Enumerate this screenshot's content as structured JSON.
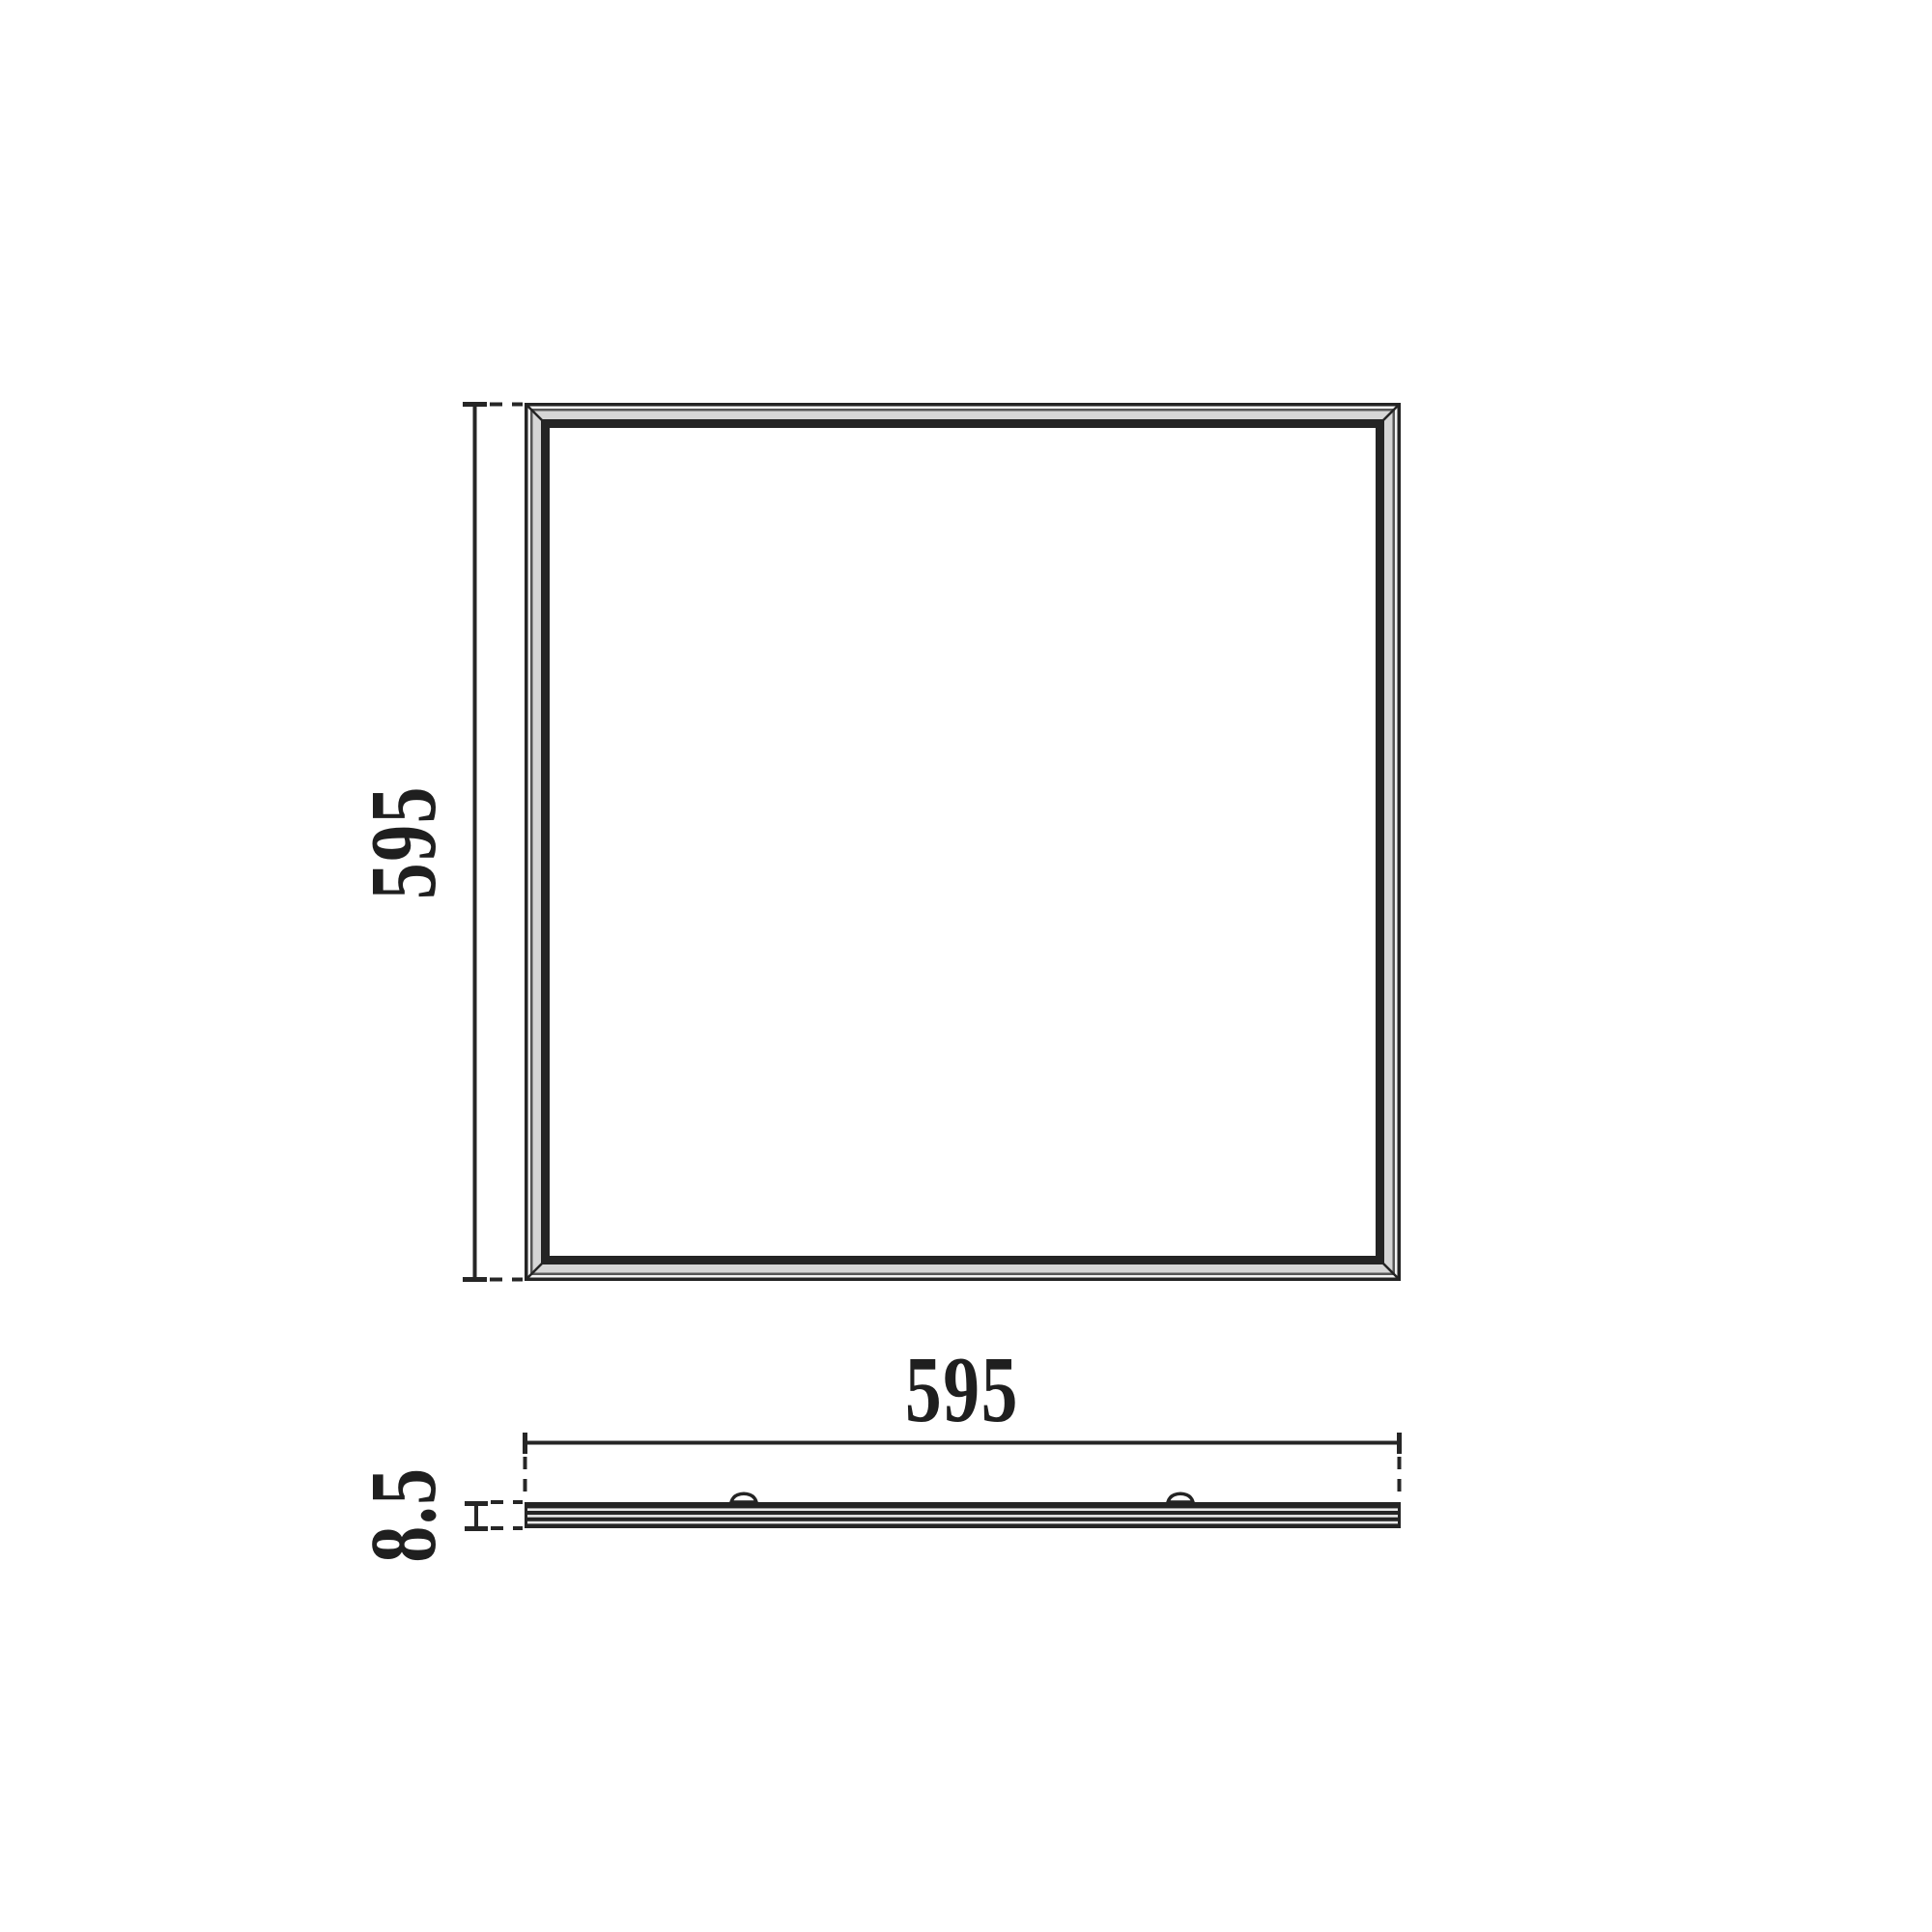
{
  "drawing": {
    "title": "panel-dimension-drawing",
    "views": {
      "front": "square-panel-front-view",
      "side": "panel-side-profile-view"
    }
  },
  "dimensions": {
    "width_label": "595",
    "height_label": "595",
    "thickness_label": "8.5"
  },
  "colors": {
    "line": "#262626",
    "text": "#1f1f1f",
    "frame_band": "#d6d6d6",
    "frame_line": "#242424",
    "background": "#ffffff"
  }
}
